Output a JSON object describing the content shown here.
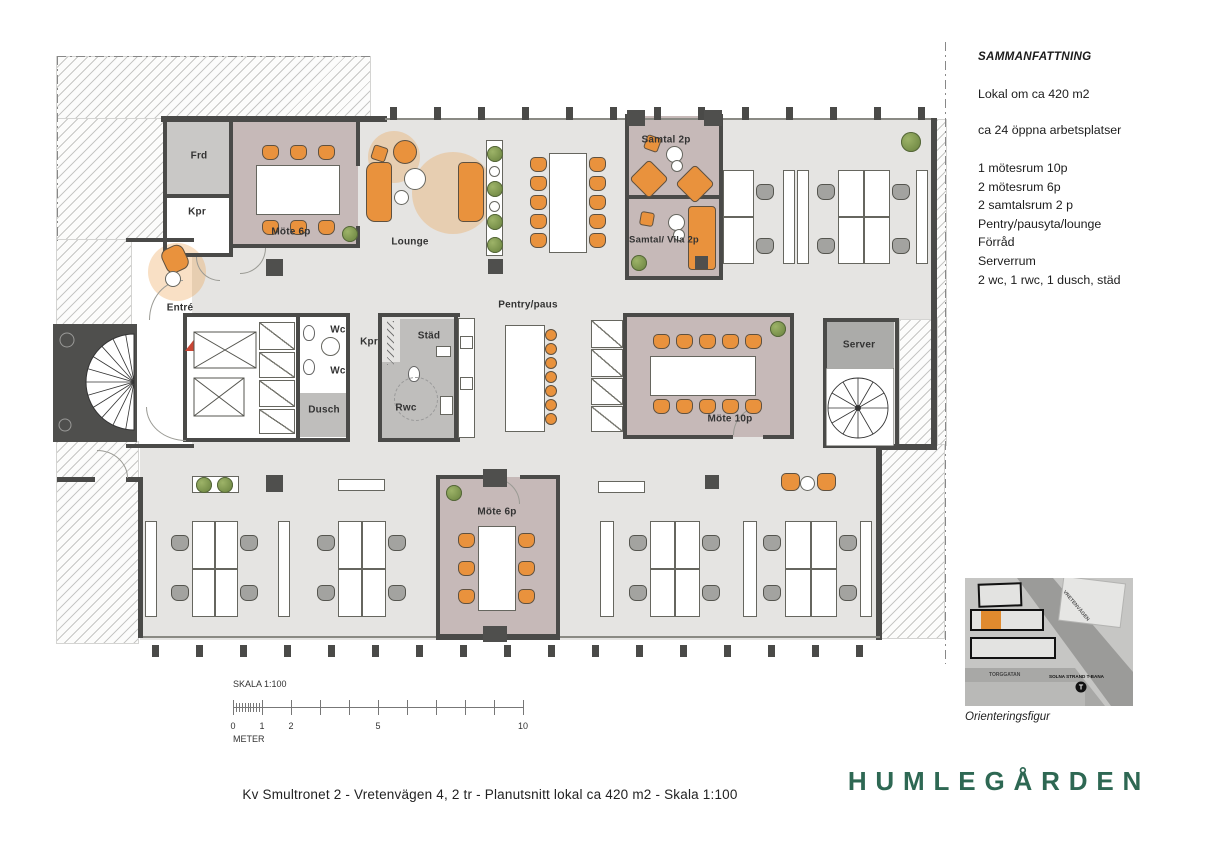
{
  "summary": {
    "title": "SAMMANFATTNING",
    "line_area": "Lokal om ca 420 m2",
    "line_workplaces": "ca 24 öppna arbetsplatser",
    "items": [
      "1 mötesrum 10p",
      "2 mötesrum 6p",
      "2 samtalsrum 2 p",
      "Pentry/pausyta/lounge",
      "Förråd",
      "Serverrum",
      "2 wc,  1 rwc, 1 dusch, städ"
    ]
  },
  "rooms": {
    "frd": "Frd",
    "kpr_entrance": "Kpr",
    "mote_6p_top": "Möte 6p",
    "lounge": "Lounge",
    "entre": "Entré",
    "samtal_2p": "Samtal 2p",
    "samtal_vila_2p": "Samtal/ Vila 2p",
    "pentry_paus": "Pentry/paus",
    "wc_upper": "Wc",
    "wc_lower": "Wc",
    "kpr_core": "Kpr",
    "stad": "Städ",
    "dusch": "Dusch",
    "rwc": "Rwc",
    "mote_10p": "Möte 10p",
    "server": "Server",
    "mote_6p_bottom": "Möte 6p"
  },
  "scale_bar": {
    "title": "SKALA 1:100",
    "ticks": [
      "0",
      "1",
      "2",
      "5",
      "10"
    ],
    "unit": "METER"
  },
  "orientation": {
    "caption": "Orienteringsfigur",
    "street_1": "VRETENVÄGEN",
    "street_2": "TORGGATAN",
    "metro_label": "SOLNA STRAND T-BANA",
    "metro_symbol": "T"
  },
  "footer": {
    "title": "Kv Smultronet 2 -  Vretenvägen 4, 2 tr -  Planutsnitt lokal ca 420 m2  -  Skala 1:100"
  },
  "logo": {
    "text": "HUMLEGÅRDEN"
  },
  "colors": {
    "meeting_room": "#c6b9b8",
    "utility_room": "#c2c1bf",
    "floor": "#e5e4e2",
    "wall": "#4a4a48",
    "accent_orange": "#e9923d",
    "plant_green": "#7f9c52",
    "logo_green": "#2e6853",
    "entry_arrow_red": "#c94634"
  }
}
